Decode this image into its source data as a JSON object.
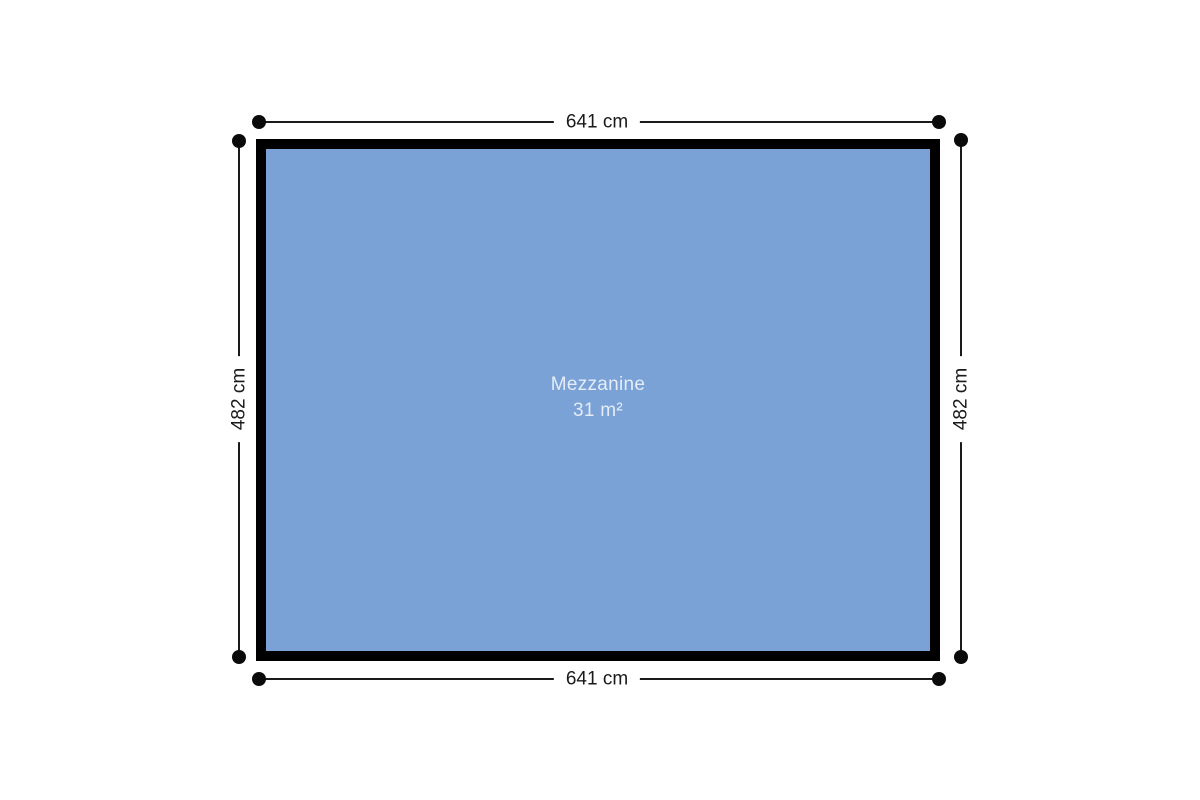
{
  "plan": {
    "room": {
      "name": "Mezzanine",
      "area": "31 m²",
      "fill_color": "#7aa2d6",
      "wall_color": "#000000",
      "label_color": "#e4ecf8"
    },
    "dimensions": {
      "top": "641 cm",
      "bottom": "641 cm",
      "left": "482 cm",
      "right": "482 cm"
    }
  }
}
